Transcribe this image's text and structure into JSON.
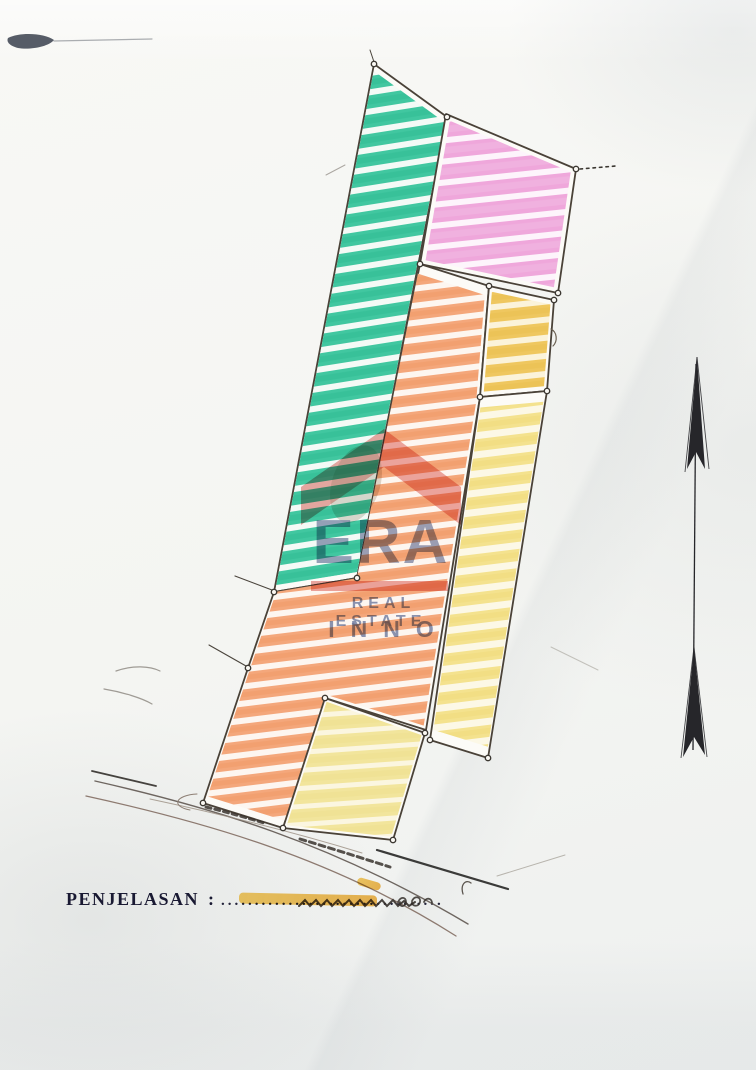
{
  "legend": {
    "label": "PENJELASAN",
    "separator": ":",
    "dots": "................................."
  },
  "watermark": {
    "brand": "ERA",
    "tagline": "REAL ESTATE",
    "subtitle": "INNO",
    "roof_color": "#d94f46",
    "text_color": "#5a6792"
  },
  "colors": {
    "paper": "#f5f5f2",
    "outline": "#4a4238",
    "teal": "#41c7a0",
    "pink": "#efa7db",
    "orange": "#f4a77b",
    "golden": "#efc75f",
    "pale_yellow": "#f4e28e",
    "light_yellow": "#f2e59c",
    "north_arrow": "#26262a",
    "legend_text": "#191932",
    "highlighter": "#f0b43c"
  },
  "drawing": {
    "outline_color": "#4a4238",
    "paper_fill": "#fcfbf7",
    "node_fill": "#faf8f3",
    "node_stroke": "#3c3832",
    "watermark_roof": "384,429 461,487 461,525 384,467 301,525 301,487",
    "patterns": [
      {
        "id": "teal",
        "base": "#f4faf6",
        "stripe": "#41c7a0",
        "stripe2": "#2fbc92",
        "period": 19,
        "stripe_w": 13,
        "angle": -9
      },
      {
        "id": "pink",
        "base": "#fdf4fb",
        "stripe": "#efa7db",
        "stripe2": "#f2bce4",
        "period": 21,
        "stripe_w": 15,
        "angle": -6
      },
      {
        "id": "orange",
        "base": "#fdf6f0",
        "stripe": "#f4a77b",
        "stripe2": "#f09a66",
        "period": 17,
        "stripe_w": 11,
        "angle": -7
      },
      {
        "id": "golden",
        "base": "#fbf3da",
        "stripe": "#efc75f",
        "stripe2": "#eabf4f",
        "period": 18,
        "stripe_w": 12,
        "angle": -6
      },
      {
        "id": "paleyellow",
        "base": "#fcf8e6",
        "stripe": "#f4e28e",
        "stripe2": "#f0da7a",
        "period": 19,
        "stripe_w": 12,
        "angle": -7
      },
      {
        "id": "lightyellow",
        "base": "#fbf6e0",
        "stripe": "#f2e59c",
        "stripe2": "#eedf8d",
        "period": 18,
        "stripe_w": 13,
        "angle": -4
      }
    ],
    "parcels": [
      {
        "name": "parcel-teal-strip",
        "pattern": "teal",
        "inset": 0.975,
        "points": "374,64 447,117 357,578 274,592"
      },
      {
        "name": "parcel-pink-block",
        "pattern": "pink",
        "inset": 0.93,
        "points": "446,114 576,169 558,293 420,264"
      },
      {
        "name": "parcel-orange-region",
        "pattern": "orange",
        "inset": 0.97,
        "points": "420,264 489,286 480,397 426,730 325,698 283,828 203,803 248,668 274,592 357,578"
      },
      {
        "name": "parcel-golden-box",
        "pattern": "golden",
        "inset": 0.9,
        "points": "489,286 554,300 547,391 480,397"
      },
      {
        "name": "parcel-pale-yellow-strip",
        "pattern": "paleyellow",
        "inset": 0.94,
        "points": "480,397 547,391 488,758 430,740"
      },
      {
        "name": "parcel-yellow-block",
        "pattern": "lightyellow",
        "inset": 0.95,
        "points": "325,698 425,733 393,840 283,828"
      }
    ],
    "nodes": "374,64 447,117 576,169 558,293 420,264 489,286 554,300 547,391 480,397 357,578 274,592 248,668 203,803 325,698 425,733 430,740 488,758 283,828 393,840",
    "lines": [
      {
        "name": "survey-tie-dotted",
        "d": "M580,169 L616,166",
        "stroke": "#3c3832",
        "w": 1.6,
        "dash": "2.5 4"
      },
      {
        "name": "leader-line",
        "d": "M272,590 L235,576",
        "stroke": "#4a443c",
        "w": 1.1
      },
      {
        "name": "leader-line",
        "d": "M246,666 L209,645",
        "stroke": "#4a443c",
        "w": 1.1
      },
      {
        "name": "leader-line",
        "d": "M374,62 L370,50",
        "stroke": "#4a443c",
        "w": 1
      },
      {
        "name": "road-edge",
        "d": "M92,771 L156,786",
        "stroke": "#45423e",
        "w": 1.8
      },
      {
        "name": "road-edge",
        "d": "M95,781 C210,807 330,842 468,924",
        "stroke": "#6e6660",
        "w": 1.4
      },
      {
        "name": "road-edge",
        "d": "M86,796 C200,821 332,857 456,936",
        "stroke": "#8d7a70",
        "w": 1.3
      },
      {
        "name": "road-edge-faint",
        "d": "M150,799 C230,816 300,834 362,853",
        "stroke": "#9a8d81",
        "w": 1,
        "opacity": 0.8
      },
      {
        "name": "road-loop",
        "d": "M197,794 C176,795 170,806 190,810",
        "stroke": "#8d7f74",
        "w": 1
      },
      {
        "name": "road-dark-segment",
        "d": "M377,850 L508,889",
        "stroke": "#3b3b39",
        "w": 2.2
      },
      {
        "name": "road-hook",
        "d": "M463,894 C460,884 466,879 471,883",
        "stroke": "#5b554e",
        "w": 1.3
      },
      {
        "name": "pencil-scratch",
        "d": "M497,876 L565,855",
        "stroke": "#a09a90",
        "w": 1,
        "opacity": 0.7
      },
      {
        "name": "pencil-scratch",
        "d": "M551,647 L598,670",
        "stroke": "#a4a098",
        "w": 1,
        "opacity": 0.6
      },
      {
        "name": "pencil-tick",
        "d": "M326,175 L345,165",
        "stroke": "#8a857d",
        "w": 1,
        "opacity": 0.7
      },
      {
        "name": "pencil-arc",
        "d": "M116,671 C133,665 150,666 160,671",
        "stroke": "#8a857d",
        "w": 1.2,
        "opacity": 0.8
      },
      {
        "name": "pencil-arc",
        "d": "M104,689 C122,692 142,698 152,704",
        "stroke": "#8a857d",
        "w": 1.2,
        "opacity": 0.8
      },
      {
        "name": "golden-box-hook",
        "d": "M551,329 C557,332 558,341 553,346",
        "stroke": "#6a5f50",
        "w": 1.2
      },
      {
        "name": "illegible-handwriting",
        "d": "M206,807 Q238,815 264,823",
        "stroke": "#3a342e",
        "w": 3,
        "dash": "5 4",
        "opacity": 0.85
      },
      {
        "name": "illegible-handwriting",
        "d": "M300,839 Q340,851 390,867",
        "stroke": "#3a342e",
        "w": 3,
        "dash": "6 4",
        "opacity": 0.85
      },
      {
        "name": "legend-scribble",
        "d": "M299,906 l6,-6 5,6 6,-6 5,6 6,-6 5,6 6,-6 5,6 6,-6 5,6 6,-6 5,6 6,-6 5,6 6,-6 5,6 6,-6 5,6 6,-5 5,5 6,-4",
        "stroke": "#35302b",
        "w": 2,
        "opacity": 0.9
      },
      {
        "name": "legend-scribble-loops",
        "d": "M398,902 c3,-6 8,-5 8,0 c0,5 -7,6 -6,0 M412,901 c3,-6 9,-4 8,1 c-1,5 -8,5 -8,0 M424,902 c2,-5 8,-4 8,1",
        "stroke": "#35302b",
        "w": 1.8,
        "opacity": 0.85
      },
      {
        "name": "scan-smudge-tail",
        "d": "M54,41 L152,39",
        "stroke": "#6a7076",
        "w": 1.2,
        "opacity": 0.55
      }
    ],
    "arrow": {
      "shaft": "M696,364 L693,750",
      "head": "697,357 705,469 696,452 687,469",
      "tail": "694,647 705,755 694,737 683,757",
      "wings": [
        "M697,357 L685,472",
        "M697,357 L709,469",
        "M694,647 L681,758",
        "M694,647 L707,757"
      ],
      "color": "#26262a"
    },
    "smudge": {
      "path": "M8,38 C20,32 44,33 54,40 C48,47 30,50 18,48 C10,46 6,42 8,38 Z",
      "fill": "#39414e",
      "opacity": 0.85
    }
  }
}
